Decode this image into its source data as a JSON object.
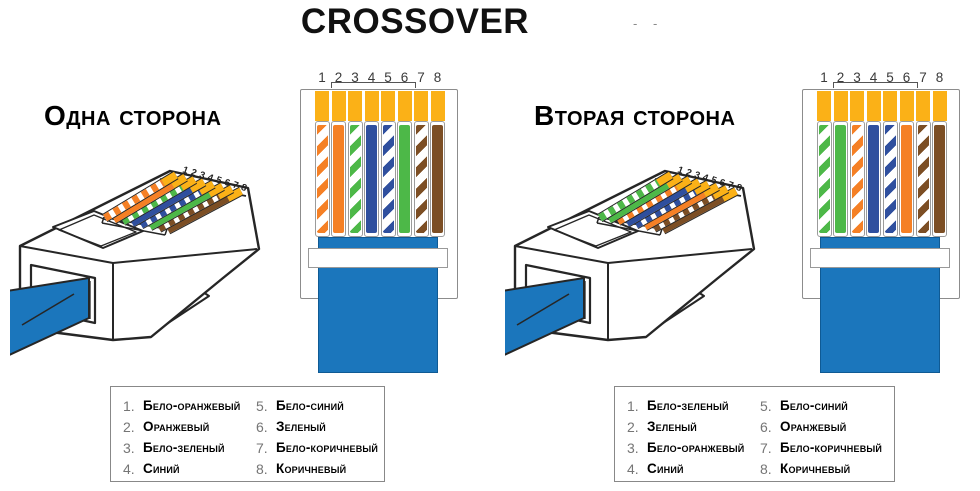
{
  "title": "CROSSOVER",
  "artifact_dashes": "- -",
  "pin_numbers": [
    "1",
    "2",
    "3",
    "4",
    "5",
    "6",
    "7",
    "8"
  ],
  "colors": {
    "orange": "#F58025",
    "green": "#4DB848",
    "blue": "#2F4F9E",
    "brown": "#7C4E24",
    "gold": "#FBB117",
    "cable": "#1B76BC",
    "outline": "#262626",
    "box_border": "#8C8C8C",
    "number_gray": "#757575"
  },
  "sides": [
    {
      "heading": "Одна сторона",
      "wires": [
        {
          "num": "1",
          "label": "Бело-оранжевый",
          "color": "#F58025",
          "striped": true
        },
        {
          "num": "2",
          "label": "Оранжевый",
          "color": "#F58025",
          "striped": false
        },
        {
          "num": "3",
          "label": "Бело-зеленый",
          "color": "#4DB848",
          "striped": true
        },
        {
          "num": "4",
          "label": "Синий",
          "color": "#2F4F9E",
          "striped": false
        },
        {
          "num": "5",
          "label": "Бело-синий",
          "color": "#2F4F9E",
          "striped": true
        },
        {
          "num": "6",
          "label": "Зеленый",
          "color": "#4DB848",
          "striped": false
        },
        {
          "num": "7",
          "label": "Бело-коричневый",
          "color": "#7C4E24",
          "striped": true
        },
        {
          "num": "8",
          "label": "Коричневый",
          "color": "#7C4E24",
          "striped": false
        }
      ]
    },
    {
      "heading": "Вторая сторона",
      "wires": [
        {
          "num": "1",
          "label": "Бело-зеленый",
          "color": "#4DB848",
          "striped": true
        },
        {
          "num": "2",
          "label": "Зеленый",
          "color": "#4DB848",
          "striped": false
        },
        {
          "num": "3",
          "label": "Бело-оранжевый",
          "color": "#F58025",
          "striped": true
        },
        {
          "num": "4",
          "label": "Синий",
          "color": "#2F4F9E",
          "striped": false
        },
        {
          "num": "5",
          "label": "Бело-синий",
          "color": "#2F4F9E",
          "striped": true
        },
        {
          "num": "6",
          "label": "Оранжевый",
          "color": "#F58025",
          "striped": false
        },
        {
          "num": "7",
          "label": "Бело-коричневый",
          "color": "#7C4E24",
          "striped": true
        },
        {
          "num": "8",
          "label": "Коричневый",
          "color": "#7C4E24",
          "striped": false
        }
      ]
    }
  ]
}
